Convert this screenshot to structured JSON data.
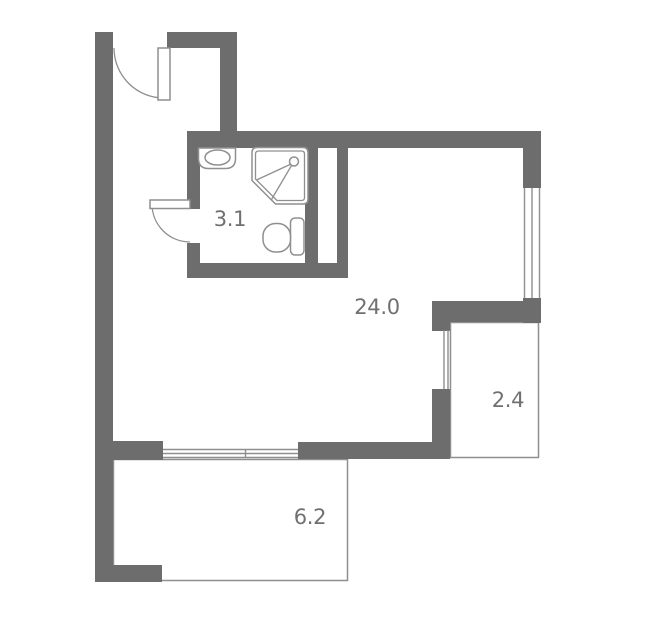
{
  "colors": {
    "wall": "#6d6d6d",
    "outline": "#8f8f8f",
    "label": "#707070",
    "background": "#ffffff"
  },
  "rooms": [
    {
      "name": "bathroom",
      "area_label": "3.1"
    },
    {
      "name": "main-room",
      "area_label": "24.0"
    },
    {
      "name": "balcony-right",
      "area_label": "2.4"
    },
    {
      "name": "balcony-bottom",
      "area_label": "6.2"
    }
  ],
  "icons": {
    "fixtures": [
      "sink-icon",
      "shower-icon",
      "toilet-icon"
    ],
    "doors": [
      "entrance-door-icon",
      "bathroom-door-icon"
    ],
    "windows": [
      "window-right",
      "window-balcony-right",
      "window-bottom"
    ]
  }
}
